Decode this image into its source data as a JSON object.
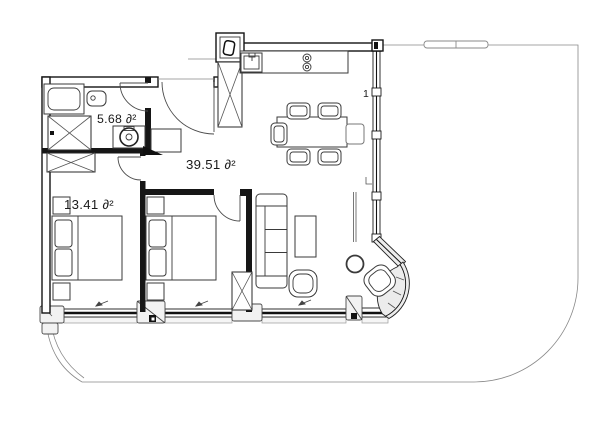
{
  "plan": {
    "rooms": {
      "bathroom": {
        "area": "5.68 ∂²"
      },
      "bedroom": {
        "area": "13.41 ∂²"
      },
      "living": {
        "area": "39.51 ∂²"
      }
    },
    "marks": {
      "right_wall_window": "1"
    },
    "colors": {
      "wall": "#141414",
      "interior_wall": "#161616",
      "background": "#ffffff",
      "window_band": "#eeeeee",
      "terrace_line": "#777777"
    }
  }
}
